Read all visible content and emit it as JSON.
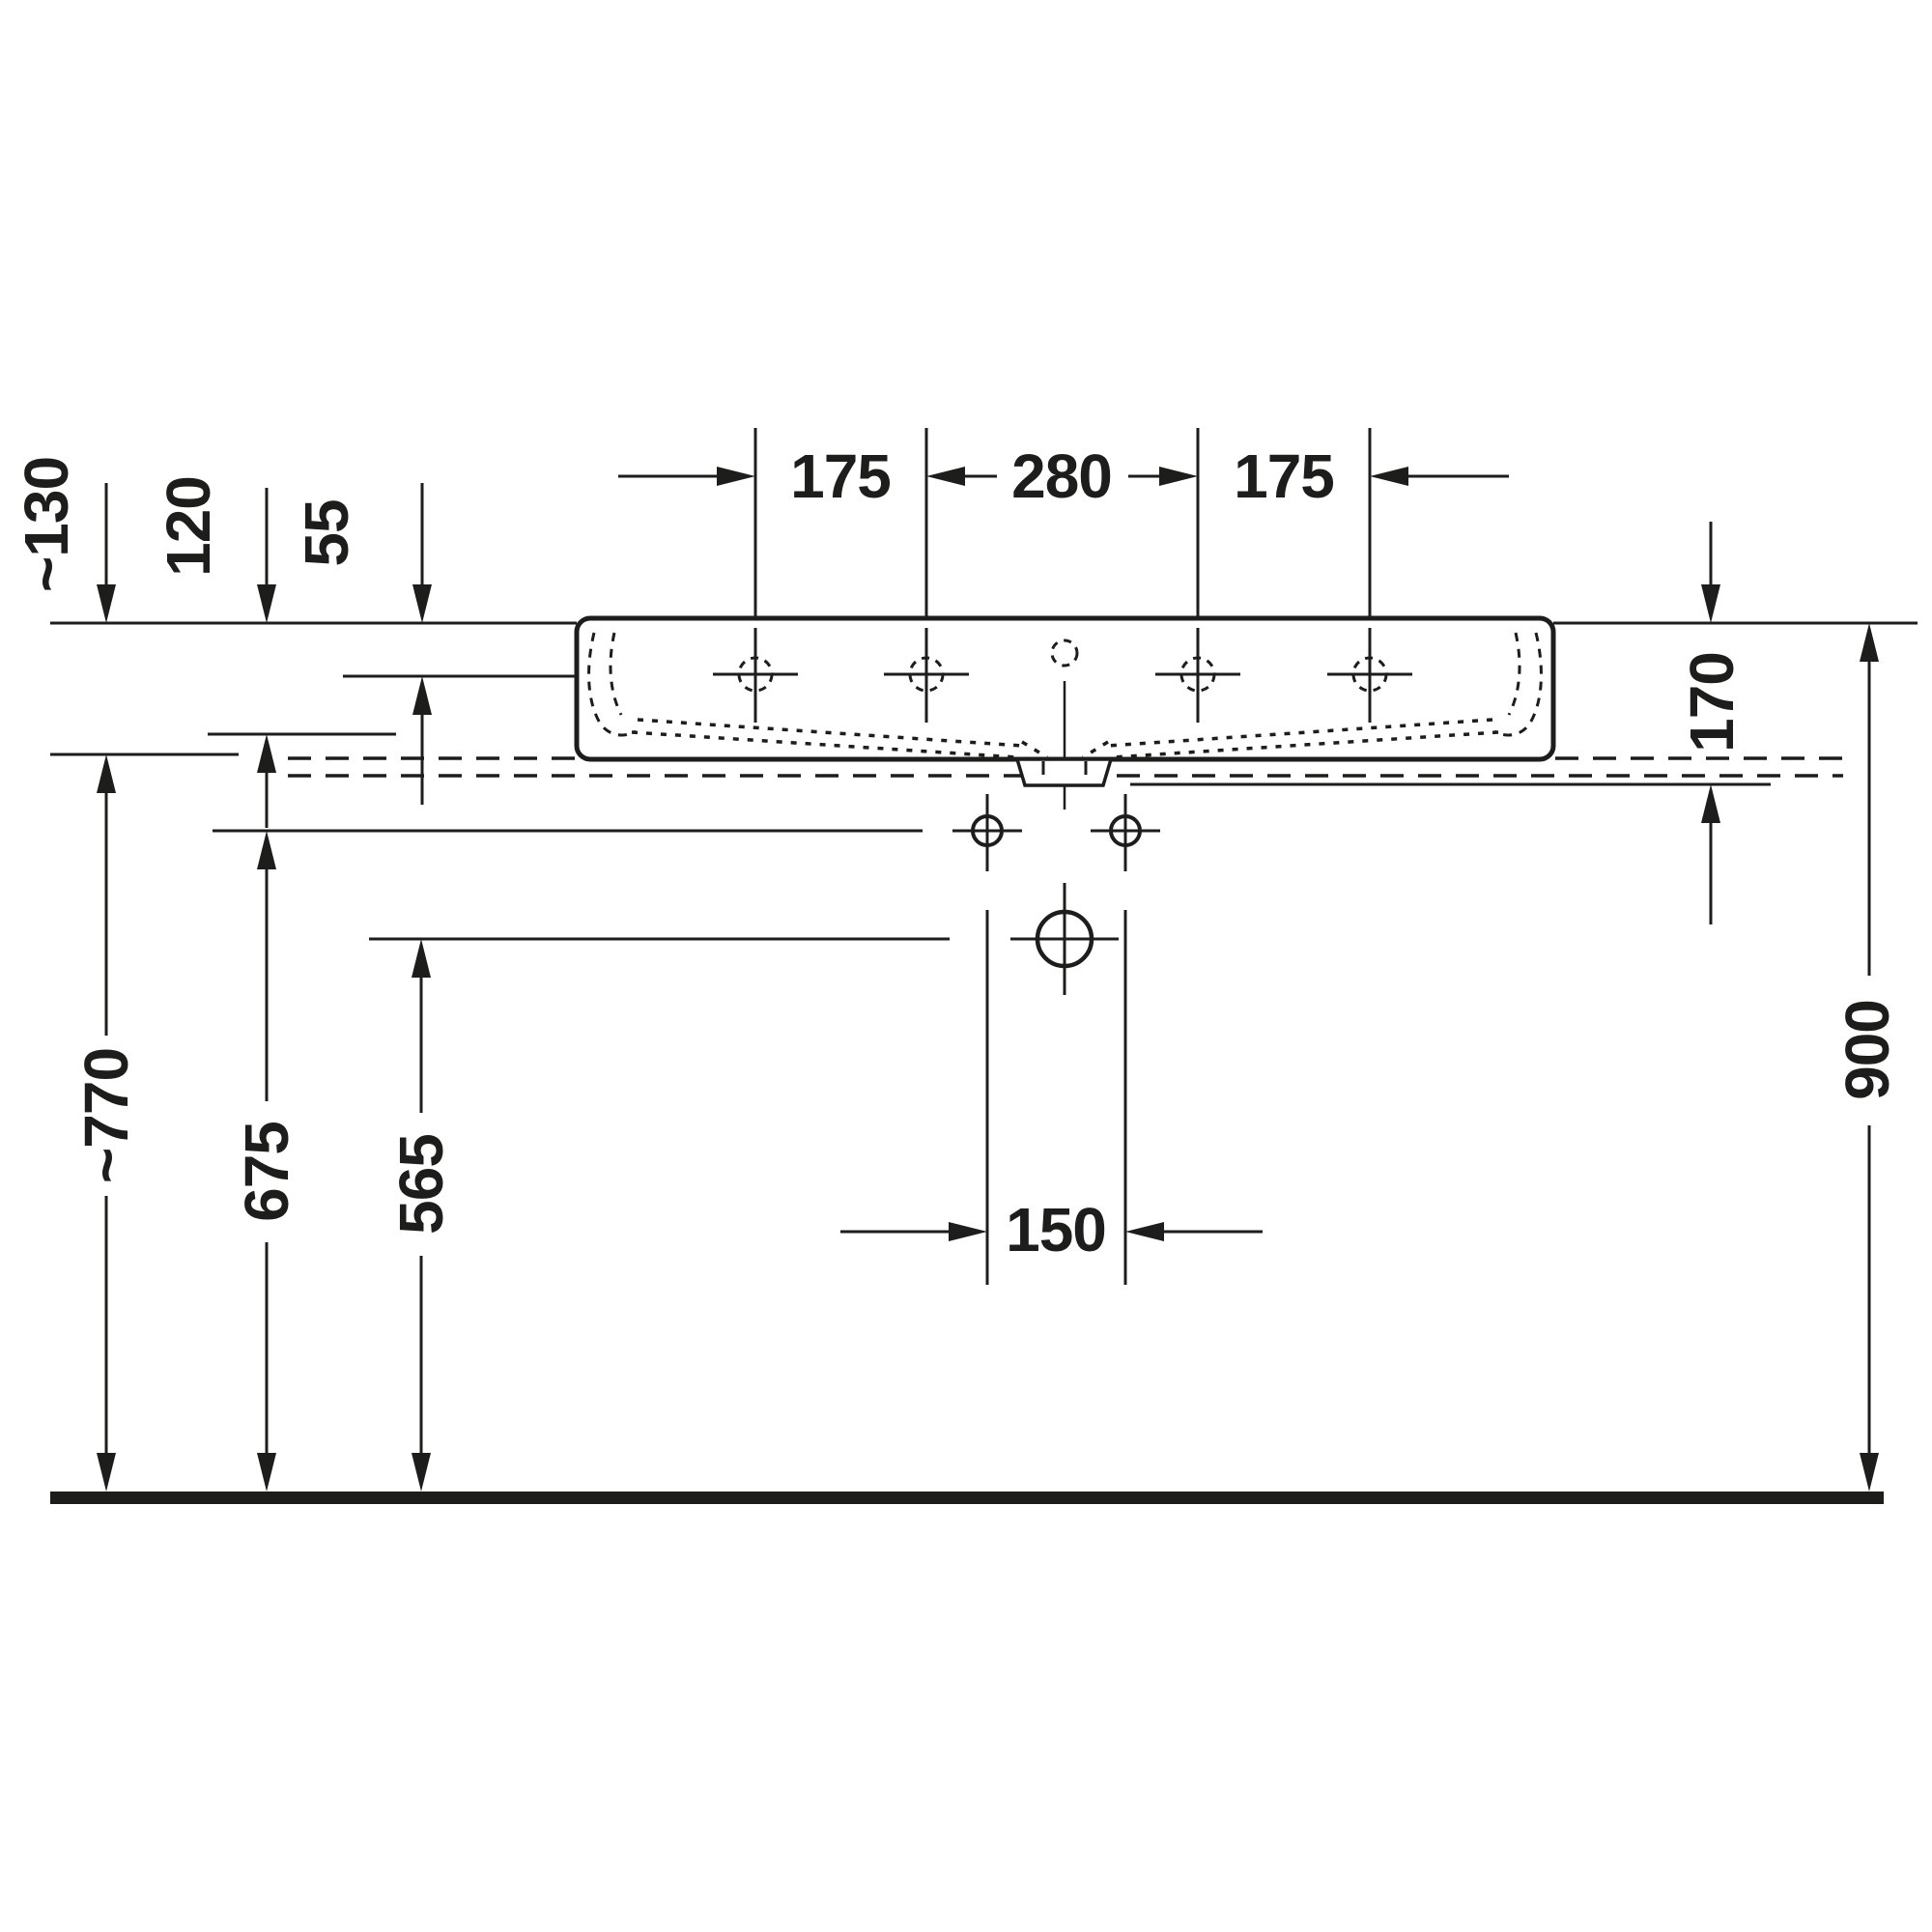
{
  "drawing": {
    "kind": "technical installation drawing",
    "subject": "wall-mounted washbasin, front elevation with installation dimensions",
    "units": "mm",
    "line_color": "#1d1d1b",
    "background_color": "#ffffff"
  },
  "dimensions": {
    "tap_hole_left_offset": {
      "value": "175",
      "orientation": "horizontal"
    },
    "tap_hole_center_span": {
      "value": "280",
      "orientation": "horizontal"
    },
    "tap_hole_right_offset": {
      "value": "175",
      "orientation": "horizontal"
    },
    "rim_to_tap_hole": {
      "value": "55",
      "orientation": "vertical"
    },
    "rim_to_overflow_level": {
      "value": "120",
      "orientation": "vertical"
    },
    "rim_to_basin_underside": {
      "value": "~130",
      "orientation": "vertical"
    },
    "rim_to_wall_line": {
      "value": "170",
      "orientation": "vertical"
    },
    "floor_to_basin_underside": {
      "value": "~770",
      "orientation": "vertical"
    },
    "floor_to_fixing_holes": {
      "value": "675",
      "orientation": "vertical"
    },
    "floor_to_drain_center": {
      "value": "565",
      "orientation": "vertical"
    },
    "floor_to_rim": {
      "value": "900",
      "orientation": "vertical"
    },
    "fixing_hole_spacing": {
      "value": "150",
      "orientation": "horizontal"
    }
  }
}
